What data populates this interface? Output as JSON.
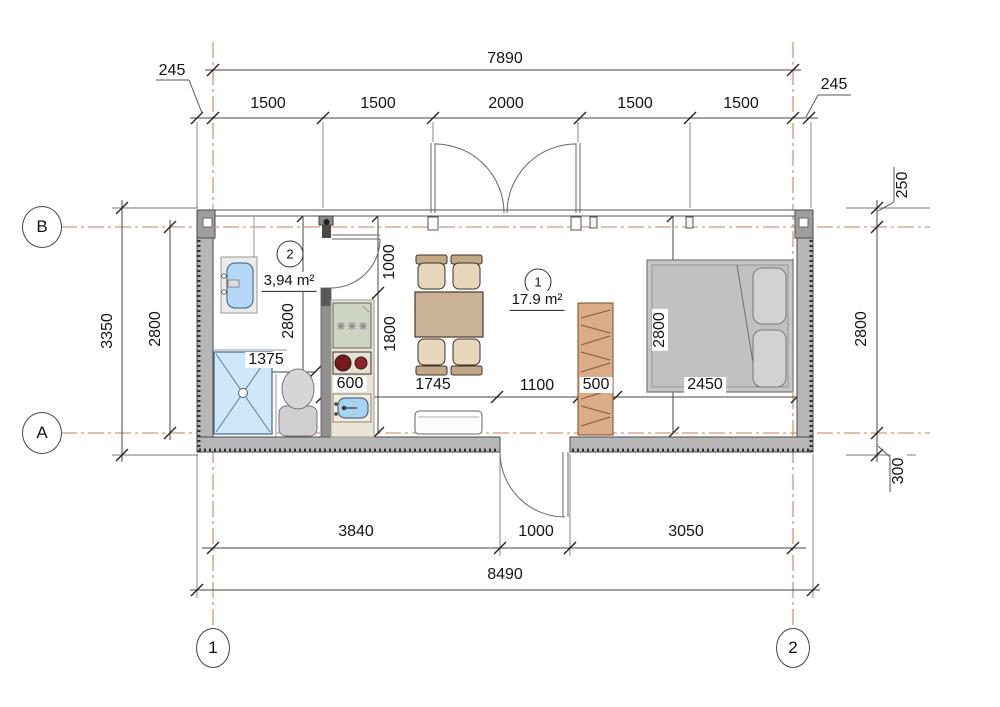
{
  "axes": {
    "row_top": "B",
    "row_bottom": "A",
    "col_left": "1",
    "col_right": "2"
  },
  "rooms": {
    "main": {
      "number": "1",
      "area": "17.9 m²"
    },
    "bathroom": {
      "number": "2",
      "area": "3,94 m²"
    }
  },
  "dimensions": {
    "top": {
      "overall": "7890",
      "left_offset": "245",
      "right_offset": "245",
      "segments": [
        "1500",
        "1500",
        "2000",
        "1500",
        "1500"
      ]
    },
    "bottom": {
      "segments": [
        "3840",
        "1000",
        "3050"
      ],
      "overall": "8490"
    },
    "left": {
      "overall": "3350",
      "inner": "2800"
    },
    "right": {
      "top_offset": "250",
      "inner": "2800",
      "bottom_offset": "300"
    },
    "interior": {
      "widths": [
        "1375",
        "600",
        "1745",
        "1100",
        "500",
        "2450"
      ],
      "kitchen_upper": "1000",
      "kitchen_lower": "1800",
      "bathroom_depth": "2800",
      "bedroom_depth": "2800"
    }
  },
  "colors": {
    "axis_line": "#c97f5e",
    "wall_fill": "#b7b7b7",
    "water_blue": "#a9d2f2",
    "shower_blue": "#cfe7f8",
    "wood_tan": "#c9b296",
    "wardrobe_tan": "#dcab87",
    "bed_gray": "#c6c6c6",
    "burner_red": "#7a1b1b"
  }
}
